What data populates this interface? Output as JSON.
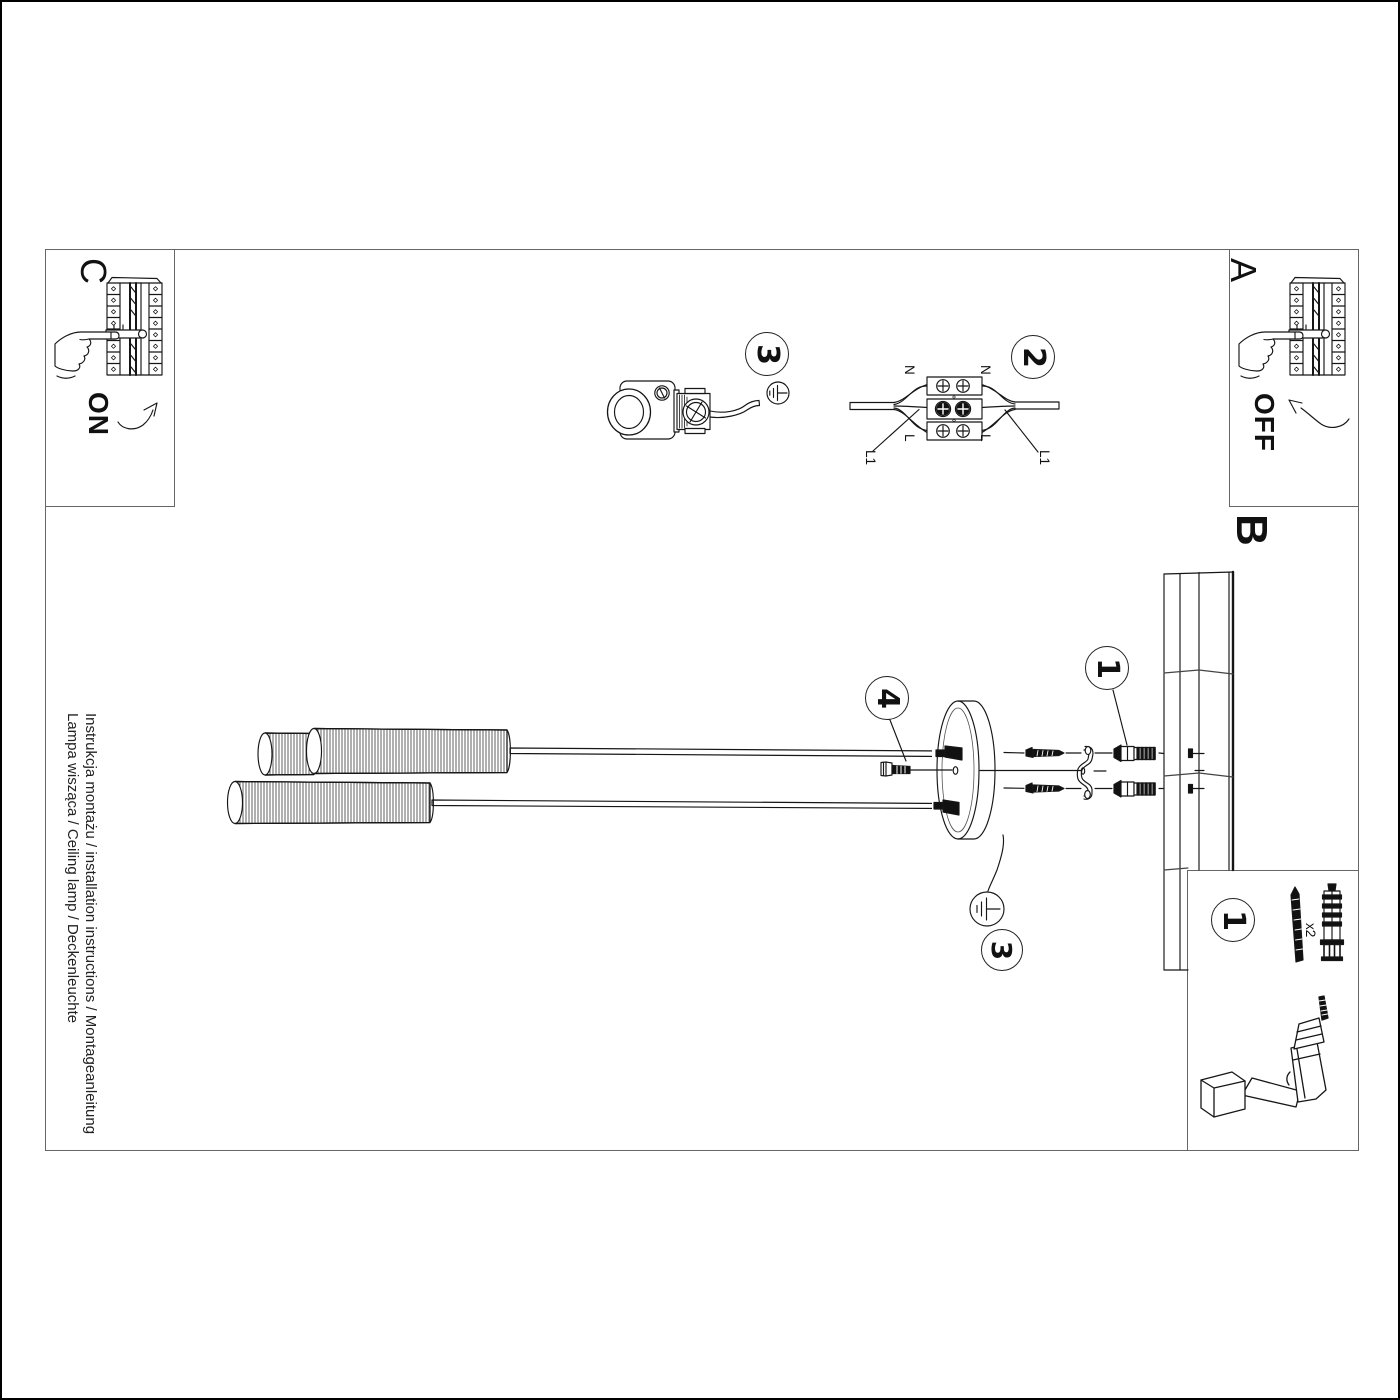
{
  "colors": {
    "ink": "#161616",
    "frame": "#555555",
    "paper": "#ffffff"
  },
  "sections": {
    "a": {
      "label": "A",
      "state": "OFF"
    },
    "b": {
      "label": "B"
    },
    "c": {
      "label": "C",
      "state": "ON"
    }
  },
  "badges": {
    "hook_step": "3",
    "terminal_step": "2",
    "wall_step": "1",
    "bolt_step": "4",
    "canopy_earth_step": "3",
    "kit_step": "1"
  },
  "terminal": {
    "n_left": "N",
    "n_right": "N",
    "l_left": "L",
    "l_right": "L",
    "l1_left": "L1",
    "l1_right": "L1"
  },
  "kit": {
    "qty": "x2"
  },
  "footer": {
    "line1": "Instrukcja montażu / installation instructions / Montageanleitung",
    "line2": "Lampa wisząca / Ceiling lamp / Deckenleuchte"
  }
}
